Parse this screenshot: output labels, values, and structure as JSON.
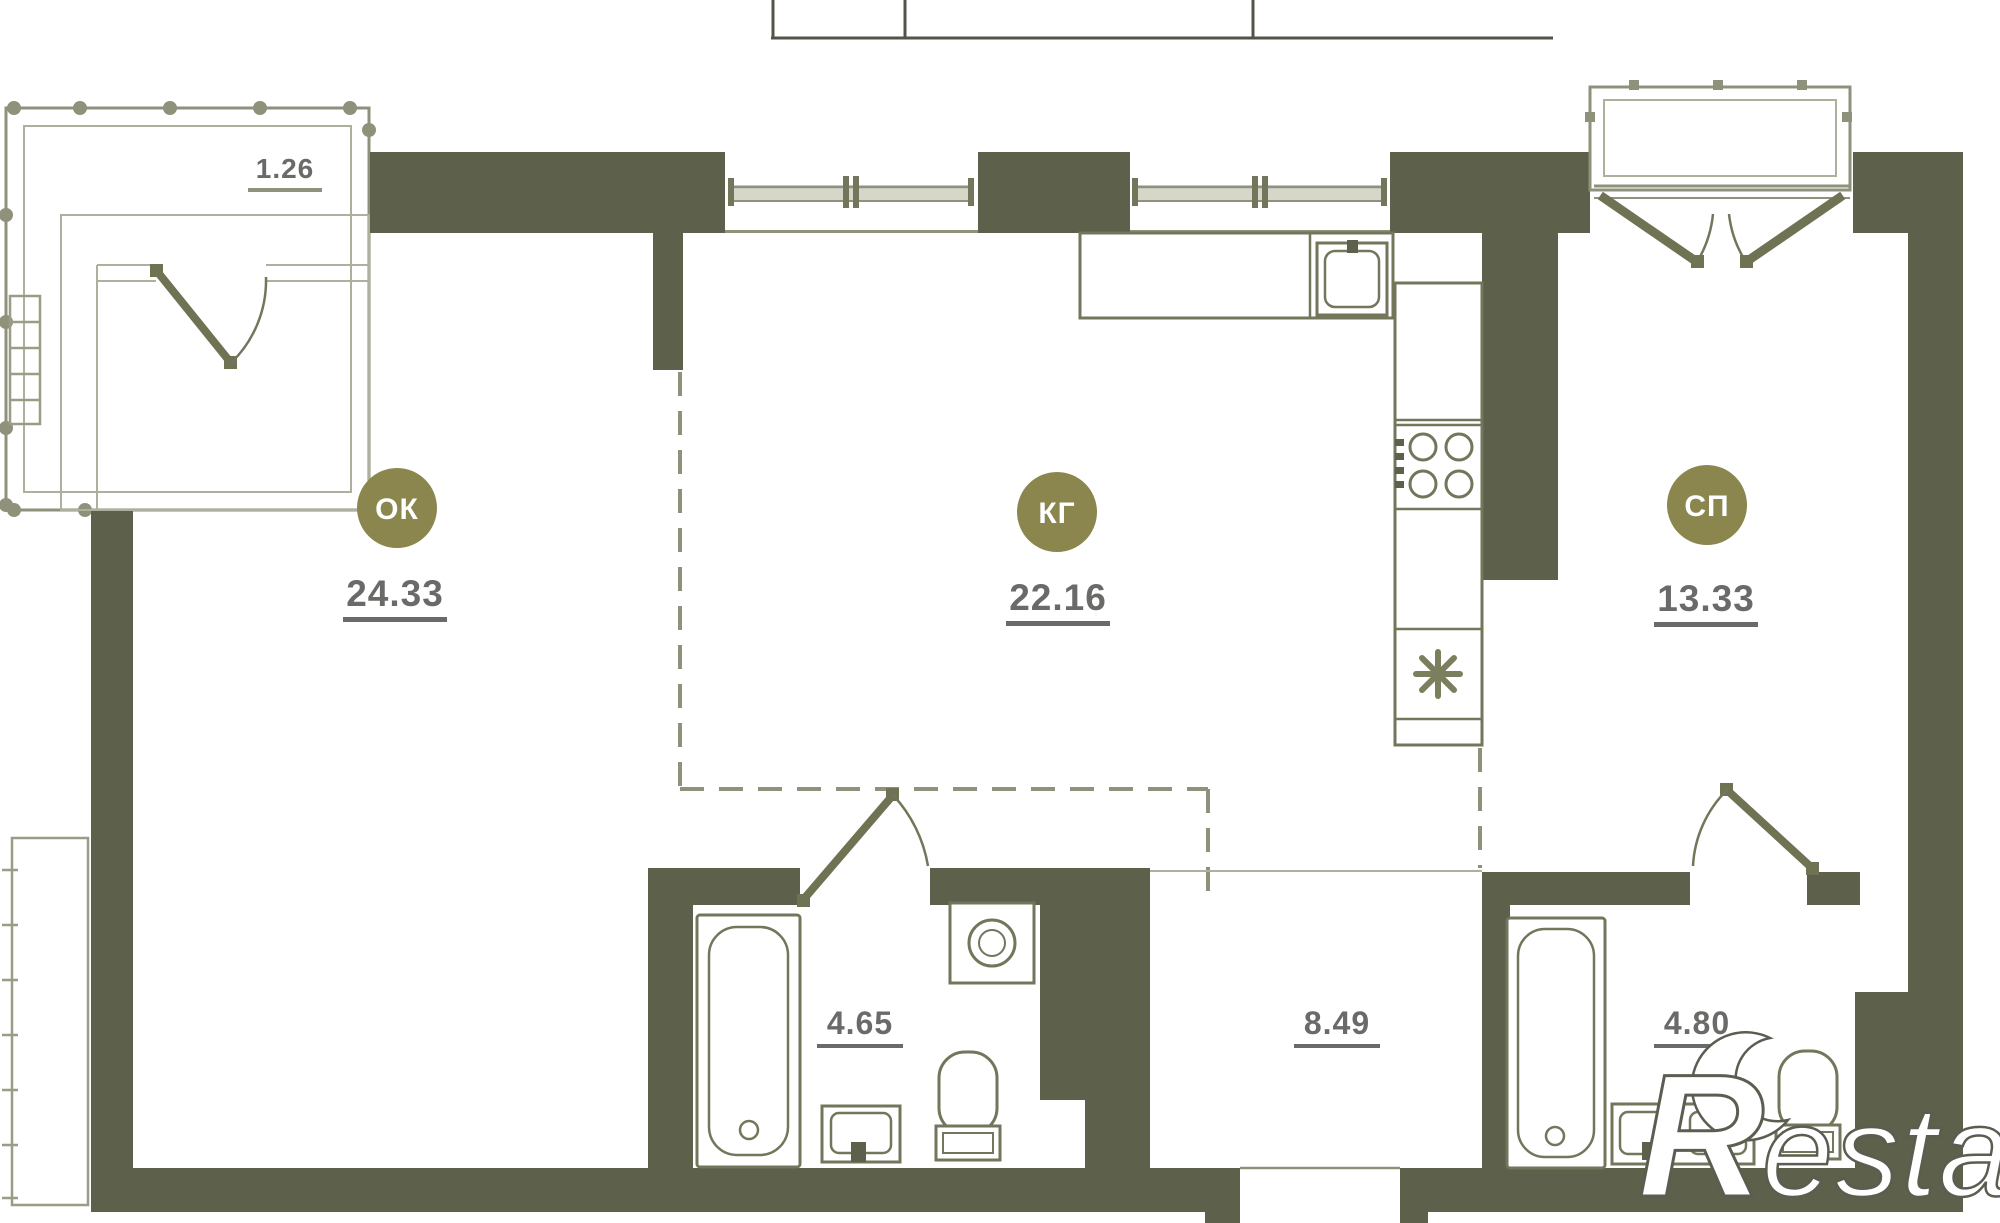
{
  "plan": {
    "rooms": [
      {
        "id": "living",
        "code": "ОК",
        "area": "24.33"
      },
      {
        "id": "kitchen_living",
        "code": "КГ",
        "area": "22.16"
      },
      {
        "id": "bedroom",
        "code": "СП",
        "area": "13.33"
      }
    ],
    "zones": [
      {
        "id": "bathroom_1",
        "area": "4.65"
      },
      {
        "id": "hallway",
        "area": "8.49"
      },
      {
        "id": "bathroom_2",
        "area": "4.80"
      }
    ],
    "balcony": {
      "area": "1.26"
    },
    "watermark": {
      "logo_letter": "R",
      "brand_text": "estate"
    },
    "colors": {
      "wall": "#5d604a",
      "label_circle": "#8b864e",
      "label_circle_text": "#ffffff",
      "dimension_text": "#6a6a68",
      "fixture_line": "#73765b",
      "light_line": "#aeb09c",
      "background": "#ffffff"
    }
  }
}
